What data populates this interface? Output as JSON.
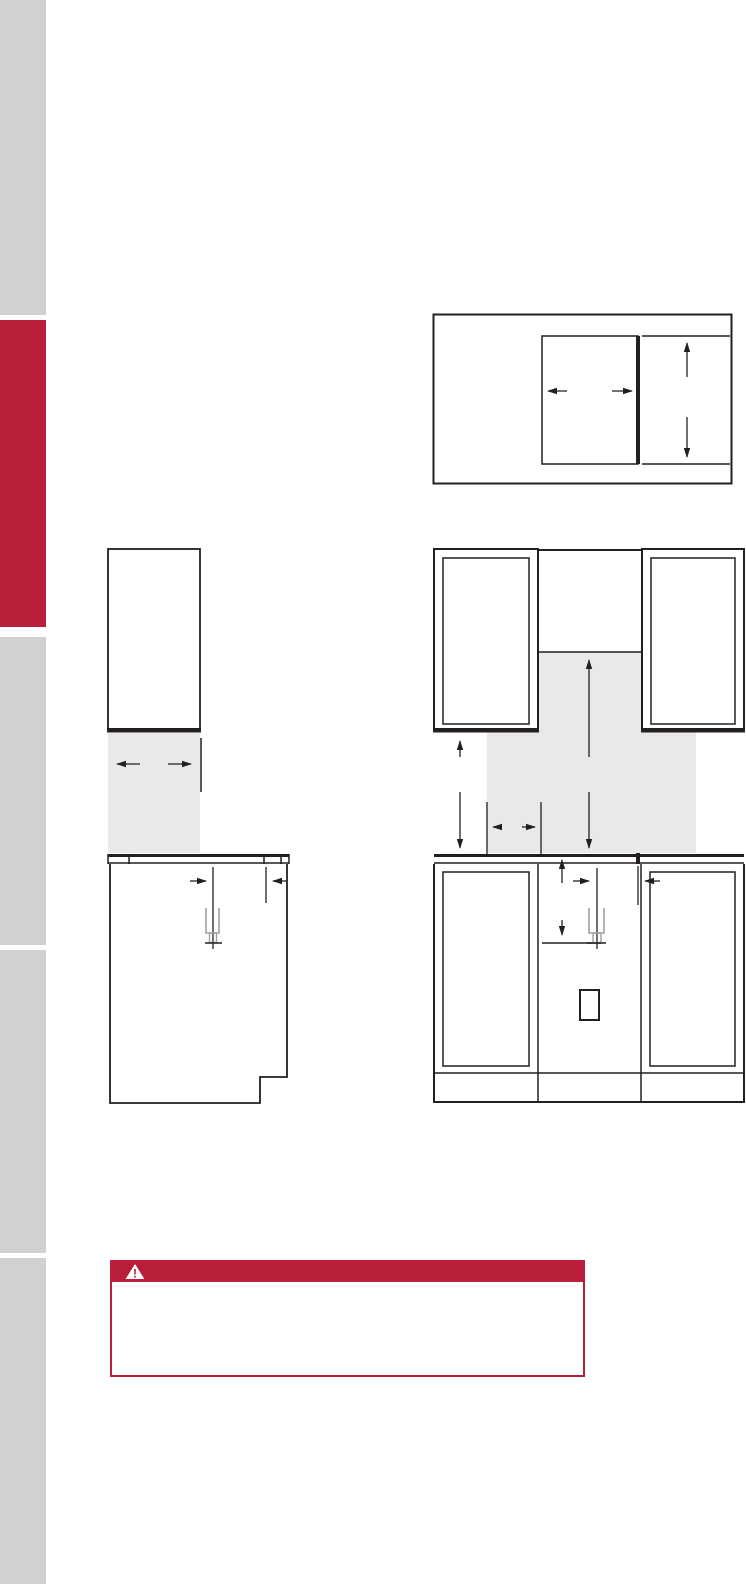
{
  "colors": {
    "page_background": "#FFFFFF",
    "accent_red": "#B91E3B",
    "edge_tab_gray": "#D1D1D1",
    "diagram_shade_gray": "#E9E9E9",
    "line_black": "#231F20",
    "gas_symbol_gray": "#A0A0A0"
  },
  "sidebar": {
    "tab_count": 5,
    "tab_colors": [
      "gray",
      "red",
      "gray",
      "gray",
      "gray"
    ]
  },
  "warning": {
    "icon": "warning-triangle-icon",
    "icon_glyph": "!"
  }
}
